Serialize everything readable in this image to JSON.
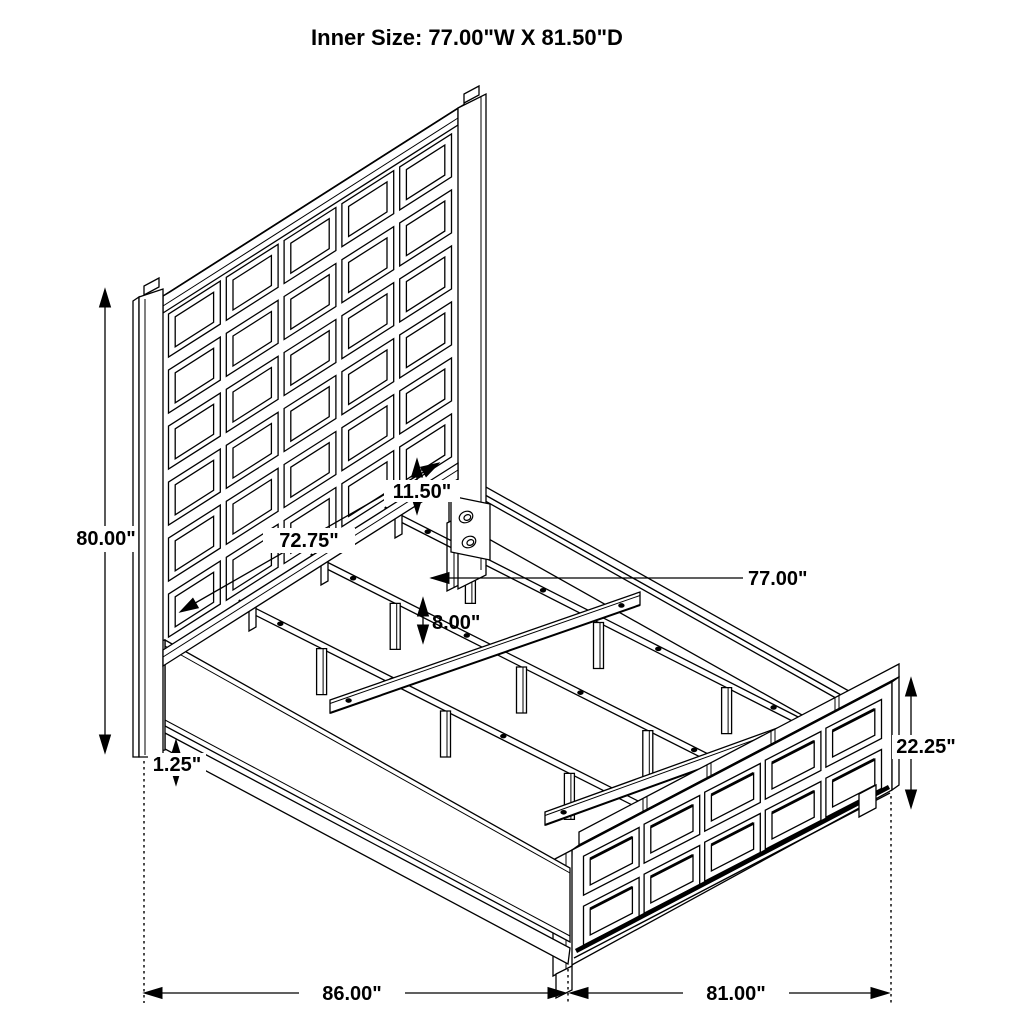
{
  "title": "Inner Size: 77.00\"W X 81.50\"D",
  "diagram": {
    "type": "isometric-dimension-drawing",
    "subject": "panel bed frame with grid headboard, grid footboard, side rails and slat supports",
    "units": "inches",
    "line_color": "#000000",
    "background_color": "#ffffff"
  },
  "annotations": {
    "headboard_height": "80.00\"",
    "headboard_panel_width": "72.75\"",
    "headboard_to_rail_gap": "11.50\"",
    "inner_rail_width": "77.00\"",
    "support_leg_height": "8.00\"",
    "base_trim_height": "1.25\"",
    "footboard_height": "22.25\"",
    "overall_width": "86.00\"",
    "overall_depth": "81.00\""
  }
}
